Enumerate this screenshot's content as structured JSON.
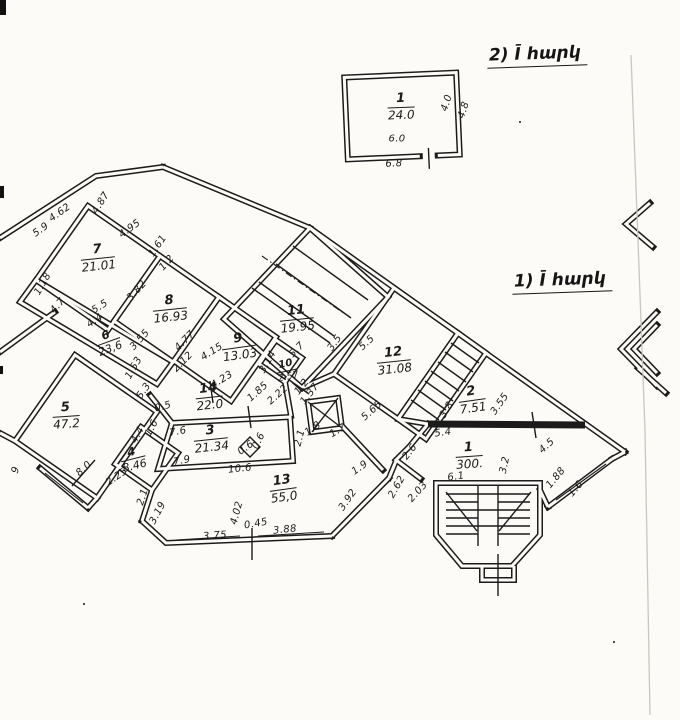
{
  "colors": {
    "ink": "#1b1b1b",
    "paper": "#fcfbf8",
    "crease": "#c9c6bf"
  },
  "titles": {
    "upper": "2) Ī հարկ",
    "lower": "1) Ī հարկ"
  },
  "rooms": [
    {
      "num": "1",
      "area": "24.0",
      "x": 401,
      "y": 107,
      "rot": -2,
      "size": ""
    },
    {
      "num": "7",
      "area": "21.01",
      "x": 98,
      "y": 258,
      "rot": -6,
      "size": ""
    },
    {
      "num": "8",
      "area": "16.93",
      "x": 170,
      "y": 309,
      "rot": -6,
      "size": ""
    },
    {
      "num": "6",
      "area": "23,6",
      "x": 108,
      "y": 342,
      "rot": -20,
      "size": "md"
    },
    {
      "num": "9",
      "area": "13.03",
      "x": 239,
      "y": 347,
      "rot": -8,
      "size": ""
    },
    {
      "num": "10",
      "area": "2.57",
      "x": 287,
      "y": 371,
      "rot": -12,
      "size": "sm"
    },
    {
      "num": "11",
      "area": "19.95",
      "x": 297,
      "y": 319,
      "rot": -6,
      "size": ""
    },
    {
      "num": "12",
      "area": "31.08",
      "x": 394,
      "y": 361,
      "rot": -6,
      "size": ""
    },
    {
      "num": "5",
      "area": "47.2",
      "x": 66,
      "y": 416,
      "rot": -4,
      "size": ""
    },
    {
      "num": "4",
      "area": "8.46",
      "x": 133,
      "y": 459,
      "rot": -14,
      "size": "md"
    },
    {
      "num": "14",
      "area": "22.0",
      "x": 209,
      "y": 397,
      "rot": -6,
      "size": ""
    },
    {
      "num": "3",
      "area": "21.34",
      "x": 211,
      "y": 439,
      "rot": -6,
      "size": ""
    },
    {
      "num": "13",
      "area": "55,0",
      "x": 283,
      "y": 489,
      "rot": -8,
      "size": ""
    },
    {
      "num": "2",
      "area": "7.51",
      "x": 472,
      "y": 400,
      "rot": -8,
      "size": ""
    },
    {
      "num": "1",
      "area": "300.",
      "x": 469,
      "y": 456,
      "rot": -4,
      "size": ""
    }
  ],
  "dims": [
    {
      "t": "6.0",
      "x": 397,
      "y": 139,
      "r": 0
    },
    {
      "t": "6.8",
      "x": 394,
      "y": 164,
      "r": -2
    },
    {
      "t": "4.0",
      "x": 447,
      "y": 103,
      "r": -72
    },
    {
      "t": "4.8",
      "x": 464,
      "y": 110,
      "r": -72
    },
    {
      "t": "4.87",
      "x": 101,
      "y": 203,
      "r": -58
    },
    {
      "t": "4.62",
      "x": 60,
      "y": 213,
      "r": -36
    },
    {
      "t": "5.9",
      "x": 41,
      "y": 230,
      "r": -36
    },
    {
      "t": "4.95",
      "x": 130,
      "y": 229,
      "r": -36
    },
    {
      "t": "1.61",
      "x": 158,
      "y": 246,
      "r": -56
    },
    {
      "t": "1.2",
      "x": 167,
      "y": 263,
      "r": -48
    },
    {
      "t": "1.18",
      "x": 43,
      "y": 284,
      "r": -60
    },
    {
      "t": "4.7",
      "x": 58,
      "y": 306,
      "r": -48
    },
    {
      "t": "5.5",
      "x": 100,
      "y": 307,
      "r": -32
    },
    {
      "t": "4.4",
      "x": 95,
      "y": 321,
      "r": -32
    },
    {
      "t": "3.82",
      "x": 137,
      "y": 291,
      "r": -48
    },
    {
      "t": "3.55",
      "x": 140,
      "y": 340,
      "r": -48
    },
    {
      "t": "1.53",
      "x": 134,
      "y": 368,
      "r": -60
    },
    {
      "t": "5.3",
      "x": 144,
      "y": 391,
      "r": -55
    },
    {
      "t": "4.77",
      "x": 185,
      "y": 341,
      "r": -45
    },
    {
      "t": "2.12",
      "x": 183,
      "y": 362,
      "r": -45
    },
    {
      "t": "4.15",
      "x": 212,
      "y": 352,
      "r": -32
    },
    {
      "t": "4.23",
      "x": 222,
      "y": 380,
      "r": -32
    },
    {
      "t": "3.14",
      "x": 268,
      "y": 362,
      "r": -60
    },
    {
      "t": "1.85",
      "x": 258,
      "y": 392,
      "r": -42
    },
    {
      "t": "2.22",
      "x": 278,
      "y": 395,
      "r": -42
    },
    {
      "t": "1.2",
      "x": 302,
      "y": 387,
      "r": -52
    },
    {
      "t": "1.37",
      "x": 310,
      "y": 394,
      "r": -52
    },
    {
      "t": "5.7",
      "x": 297,
      "y": 350,
      "r": -45
    },
    {
      "t": "3.5",
      "x": 335,
      "y": 343,
      "r": -55
    },
    {
      "t": "5.5",
      "x": 367,
      "y": 343,
      "r": -42
    },
    {
      "t": "5.65",
      "x": 372,
      "y": 411,
      "r": -42
    },
    {
      "t": "3.8",
      "x": 447,
      "y": 410,
      "r": -58
    },
    {
      "t": "3.55",
      "x": 500,
      "y": 404,
      "r": -55
    },
    {
      "t": "5.4",
      "x": 443,
      "y": 433,
      "r": -8
    },
    {
      "t": "2.6",
      "x": 410,
      "y": 452,
      "r": -52
    },
    {
      "t": "4.5",
      "x": 547,
      "y": 446,
      "r": -42
    },
    {
      "t": "3.2",
      "x": 505,
      "y": 465,
      "r": -78
    },
    {
      "t": "6.1",
      "x": 456,
      "y": 477,
      "r": -8
    },
    {
      "t": "1.88",
      "x": 556,
      "y": 478,
      "r": -50
    },
    {
      "t": "1.6",
      "x": 576,
      "y": 489,
      "r": -50
    },
    {
      "t": "2.62",
      "x": 397,
      "y": 487,
      "r": -60
    },
    {
      "t": "2.03",
      "x": 418,
      "y": 492,
      "r": -48
    },
    {
      "t": "1.9",
      "x": 360,
      "y": 468,
      "r": -35
    },
    {
      "t": "3.92",
      "x": 348,
      "y": 500,
      "r": -55
    },
    {
      "t": "0.6",
      "x": 246,
      "y": 448,
      "r": -35
    },
    {
      "t": "0.6",
      "x": 259,
      "y": 441,
      "r": -65
    },
    {
      "t": "1.8",
      "x": 313,
      "y": 429,
      "r": -35
    },
    {
      "t": "1.7",
      "x": 338,
      "y": 431,
      "r": -30
    },
    {
      "t": "2.1",
      "x": 300,
      "y": 438,
      "r": -75
    },
    {
      "t": "7.6",
      "x": 178,
      "y": 432,
      "r": -10
    },
    {
      "t": "7.9",
      "x": 182,
      "y": 461,
      "r": -10
    },
    {
      "t": "10.6",
      "x": 240,
      "y": 469,
      "r": -6
    },
    {
      "t": "0.5",
      "x": 163,
      "y": 407,
      "r": -15
    },
    {
      "t": "1.6",
      "x": 152,
      "y": 428,
      "r": -62
    },
    {
      "t": "4.4",
      "x": 138,
      "y": 435,
      "r": -62
    },
    {
      "t": "2.25",
      "x": 117,
      "y": 477,
      "r": -35
    },
    {
      "t": "2.1",
      "x": 143,
      "y": 497,
      "r": -72
    },
    {
      "t": "3.19",
      "x": 158,
      "y": 513,
      "r": -62
    },
    {
      "t": "8.0",
      "x": 84,
      "y": 469,
      "r": -42
    },
    {
      "t": "9",
      "x": 16,
      "y": 470,
      "r": -72
    },
    {
      "t": "3.75",
      "x": 215,
      "y": 536,
      "r": -4
    },
    {
      "t": "4.02",
      "x": 237,
      "y": 513,
      "r": -75
    },
    {
      "t": "0.45",
      "x": 256,
      "y": 524,
      "r": -10
    },
    {
      "t": "3.88",
      "x": 285,
      "y": 530,
      "r": -6
    }
  ]
}
